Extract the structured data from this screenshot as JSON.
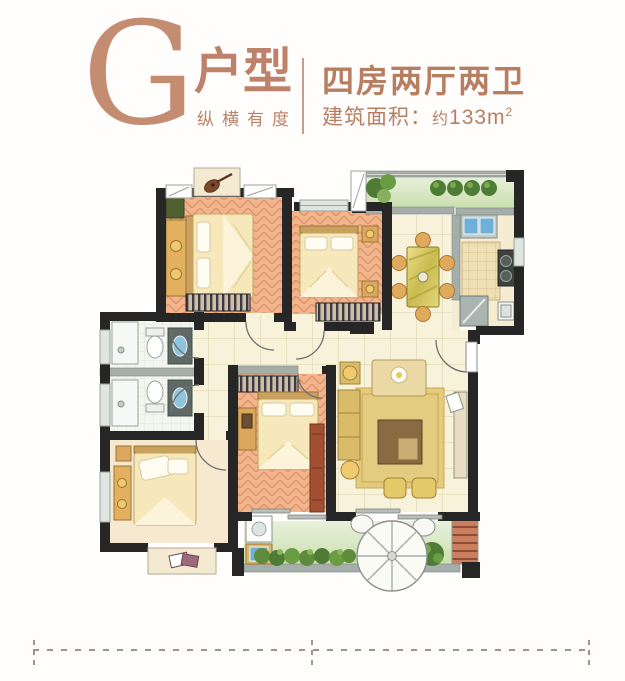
{
  "header": {
    "letter": "G",
    "type_label": "户型",
    "tagline": "纵横有度",
    "layout_label": "四房两厅两卫",
    "area_label": "建筑面积：",
    "area_approx": "约",
    "area_value": "133m",
    "area_sup": "2"
  },
  "colors": {
    "accent": "#bd8269",
    "accent_dark": "#b87e62",
    "wall_black": "#262626",
    "wall_gray": "#a6aeaa",
    "wood_floor": "#f1b48c",
    "wood_line": "#dd9468",
    "tile_floor": "#f8f2da",
    "kitchen_tile": "#eddcae",
    "balcony_green": "#c9dfae",
    "plant_green": "#5e8c3c",
    "furniture_gold": "#d9bc6a",
    "bed_cream": "#f6e8ba",
    "brick_red": "#cc7f5e",
    "water_blue": "#6db0d8",
    "dash_line": "#a0948a"
  }
}
